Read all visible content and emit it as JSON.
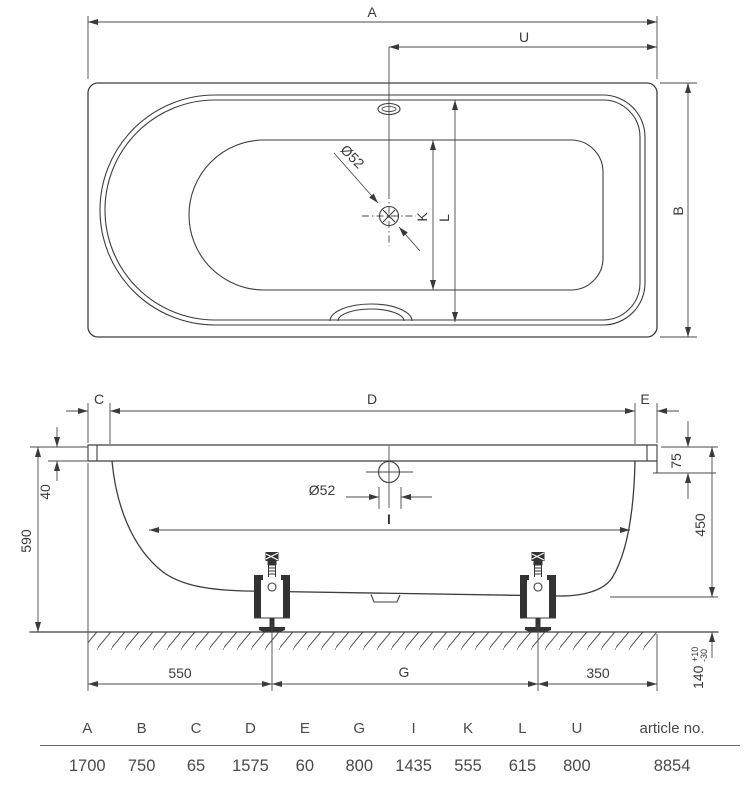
{
  "top_view": {
    "dim_a": "A",
    "dim_u": "U",
    "dim_b": "B",
    "dim_k": "K",
    "dim_l": "L",
    "drain_label": "Ø52"
  },
  "side_view": {
    "dim_c": "C",
    "dim_d": "D",
    "dim_e": "E",
    "dim_i": "I",
    "drain_label": "Ø52",
    "dim_rim_height": "40",
    "dim_overall_height": "590",
    "dim_rim_edge": "75",
    "dim_depth": "450",
    "dim_left_foot": "550",
    "dim_feet_span": "G",
    "dim_right_foot": "350",
    "dim_clearance": "140",
    "dim_clearance_tol_plus": "+10",
    "dim_clearance_tol_minus": "-30"
  },
  "table": {
    "columns": [
      "A",
      "B",
      "C",
      "D",
      "E",
      "G",
      "I",
      "K",
      "L",
      "U",
      "article no."
    ],
    "values": [
      "1700",
      "750",
      "65",
      "1575",
      "60",
      "800",
      "1435",
      "555",
      "615",
      "800",
      "8854"
    ]
  }
}
